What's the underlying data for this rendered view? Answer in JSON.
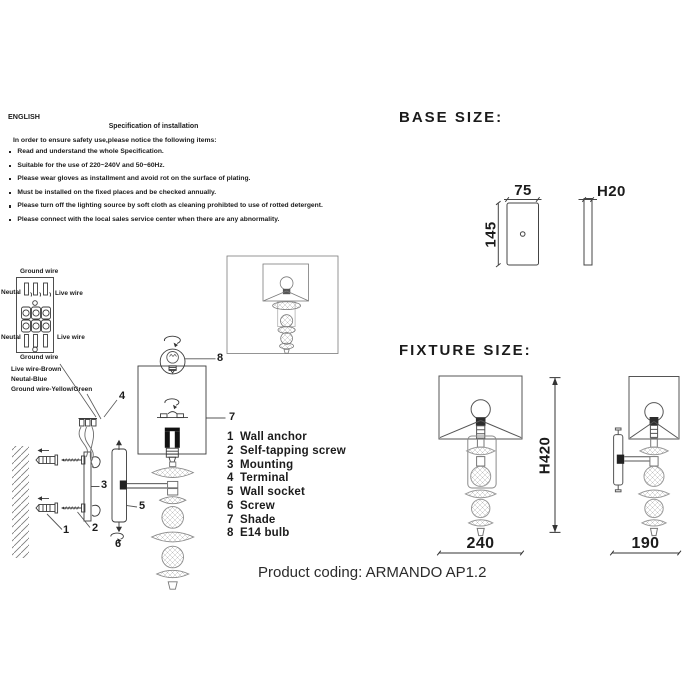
{
  "instructions": {
    "language": "ENGLISH",
    "title": "Specification of installation",
    "intro": "In order to ensure safety use,please notice the following items:",
    "items": [
      "Read and understand the whole Specification.",
      "Suitable for the use of 220~240V and 50~60Hz.",
      "Please wear gloves as installment and avoid rot on the surface of plating.",
      "Must be installed on the fixed places and be checked annually.",
      "Please turn off the lighting source by soft cloth as cleaning prohibted to use of rotted detergent.",
      "Please connect with the local sales service center when there are any abnormality."
    ]
  },
  "wiring": {
    "ground_top": "Ground wire",
    "neutral_top": "Neutal",
    "live_top": "Live wire",
    "neutral_bottom": "Neutal",
    "live_bottom": "Live wire",
    "ground_bottom": "Ground wire",
    "legend": [
      "Live wire-Brown",
      "Neutal-Blue",
      "Ground wire-Yellow/Green"
    ]
  },
  "diagram": {
    "callouts": [
      "1",
      "2",
      "3",
      "4",
      "5",
      "6",
      "7",
      "8"
    ]
  },
  "parts": {
    "items": [
      {
        "num": "1",
        "name": "Wall anchor"
      },
      {
        "num": "2",
        "name": "Self-tapping screw"
      },
      {
        "num": "3",
        "name": "Mounting"
      },
      {
        "num": "4",
        "name": "Terminal"
      },
      {
        "num": "5",
        "name": "Wall socket"
      },
      {
        "num": "6",
        "name": "Screw"
      },
      {
        "num": "7",
        "name": "Shade"
      },
      {
        "num": "8",
        "name": "E14 bulb"
      }
    ]
  },
  "base_size": {
    "title": "BASE SIZE:",
    "width": "75",
    "height": "145",
    "depth": "H20"
  },
  "fixture_size": {
    "title": "FIXTURE SIZE:",
    "height": "H420",
    "front_width": "240",
    "side_width": "190"
  },
  "footer": {
    "product_coding": "Product coding: ARMANDO AP1.2"
  },
  "colors": {
    "ink": "#1b1b1b",
    "line": "#3b3b3b",
    "light_line": "#8a8a8a"
  }
}
